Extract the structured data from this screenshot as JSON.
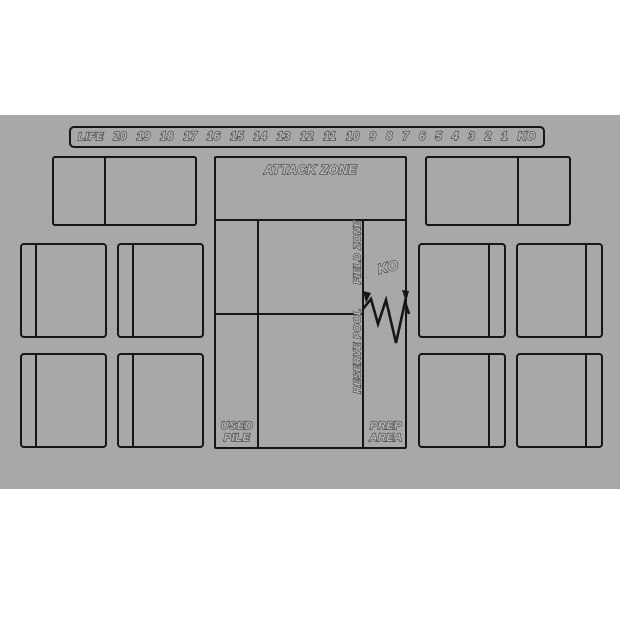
{
  "colors": {
    "page_background": "#ffffff",
    "mat_background": "#a8a8a8",
    "line": "#161616",
    "label_fill": "#b4b4b4"
  },
  "life_track": {
    "label": "LIFE",
    "values": [
      "20",
      "19",
      "18",
      "17",
      "16",
      "15",
      "14",
      "13",
      "12",
      "11",
      "10",
      "9",
      "8",
      "7",
      "6",
      "5",
      "4",
      "3",
      "2",
      "1",
      "KO"
    ]
  },
  "zones": {
    "attack_zone": "ATTACK ZONE",
    "field_zone": "FIELD ZONE",
    "reserve_pool": "RESERVE POOL",
    "ko": "KO",
    "used_pile_line1": "USED",
    "used_pile_line2": "PILE",
    "prep_area_line1": "PREP",
    "prep_area_line2": "AREA"
  }
}
